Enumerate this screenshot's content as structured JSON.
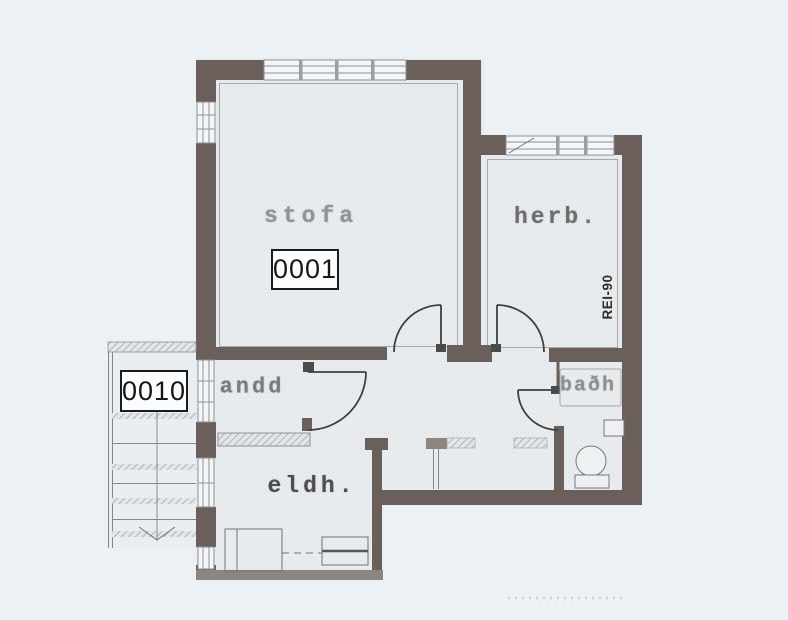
{
  "rooms": {
    "stofa": {
      "label": "stofa",
      "unit": "0001"
    },
    "herb": {
      "label": "herb."
    },
    "andd": {
      "label": "andd"
    },
    "bath": {
      "label": "baðh"
    },
    "eldh": {
      "label": "eldh."
    },
    "stairwell": {
      "unit": "0010"
    }
  },
  "annotations": {
    "fire_rating": "REI-90"
  },
  "symbols": [
    "window",
    "door-swing",
    "stairs",
    "stair-direction-arrow",
    "radiator",
    "kitchen-counter",
    "stove",
    "bathtub",
    "washbasin",
    "toilet"
  ],
  "colors": {
    "background": "#ecf1f6",
    "wall_dark": "#6a5f5a",
    "wall_light": "#8d8680",
    "linework": "#6f7377",
    "faded_label": "#8f8f8f",
    "unit_text": "#161616"
  }
}
